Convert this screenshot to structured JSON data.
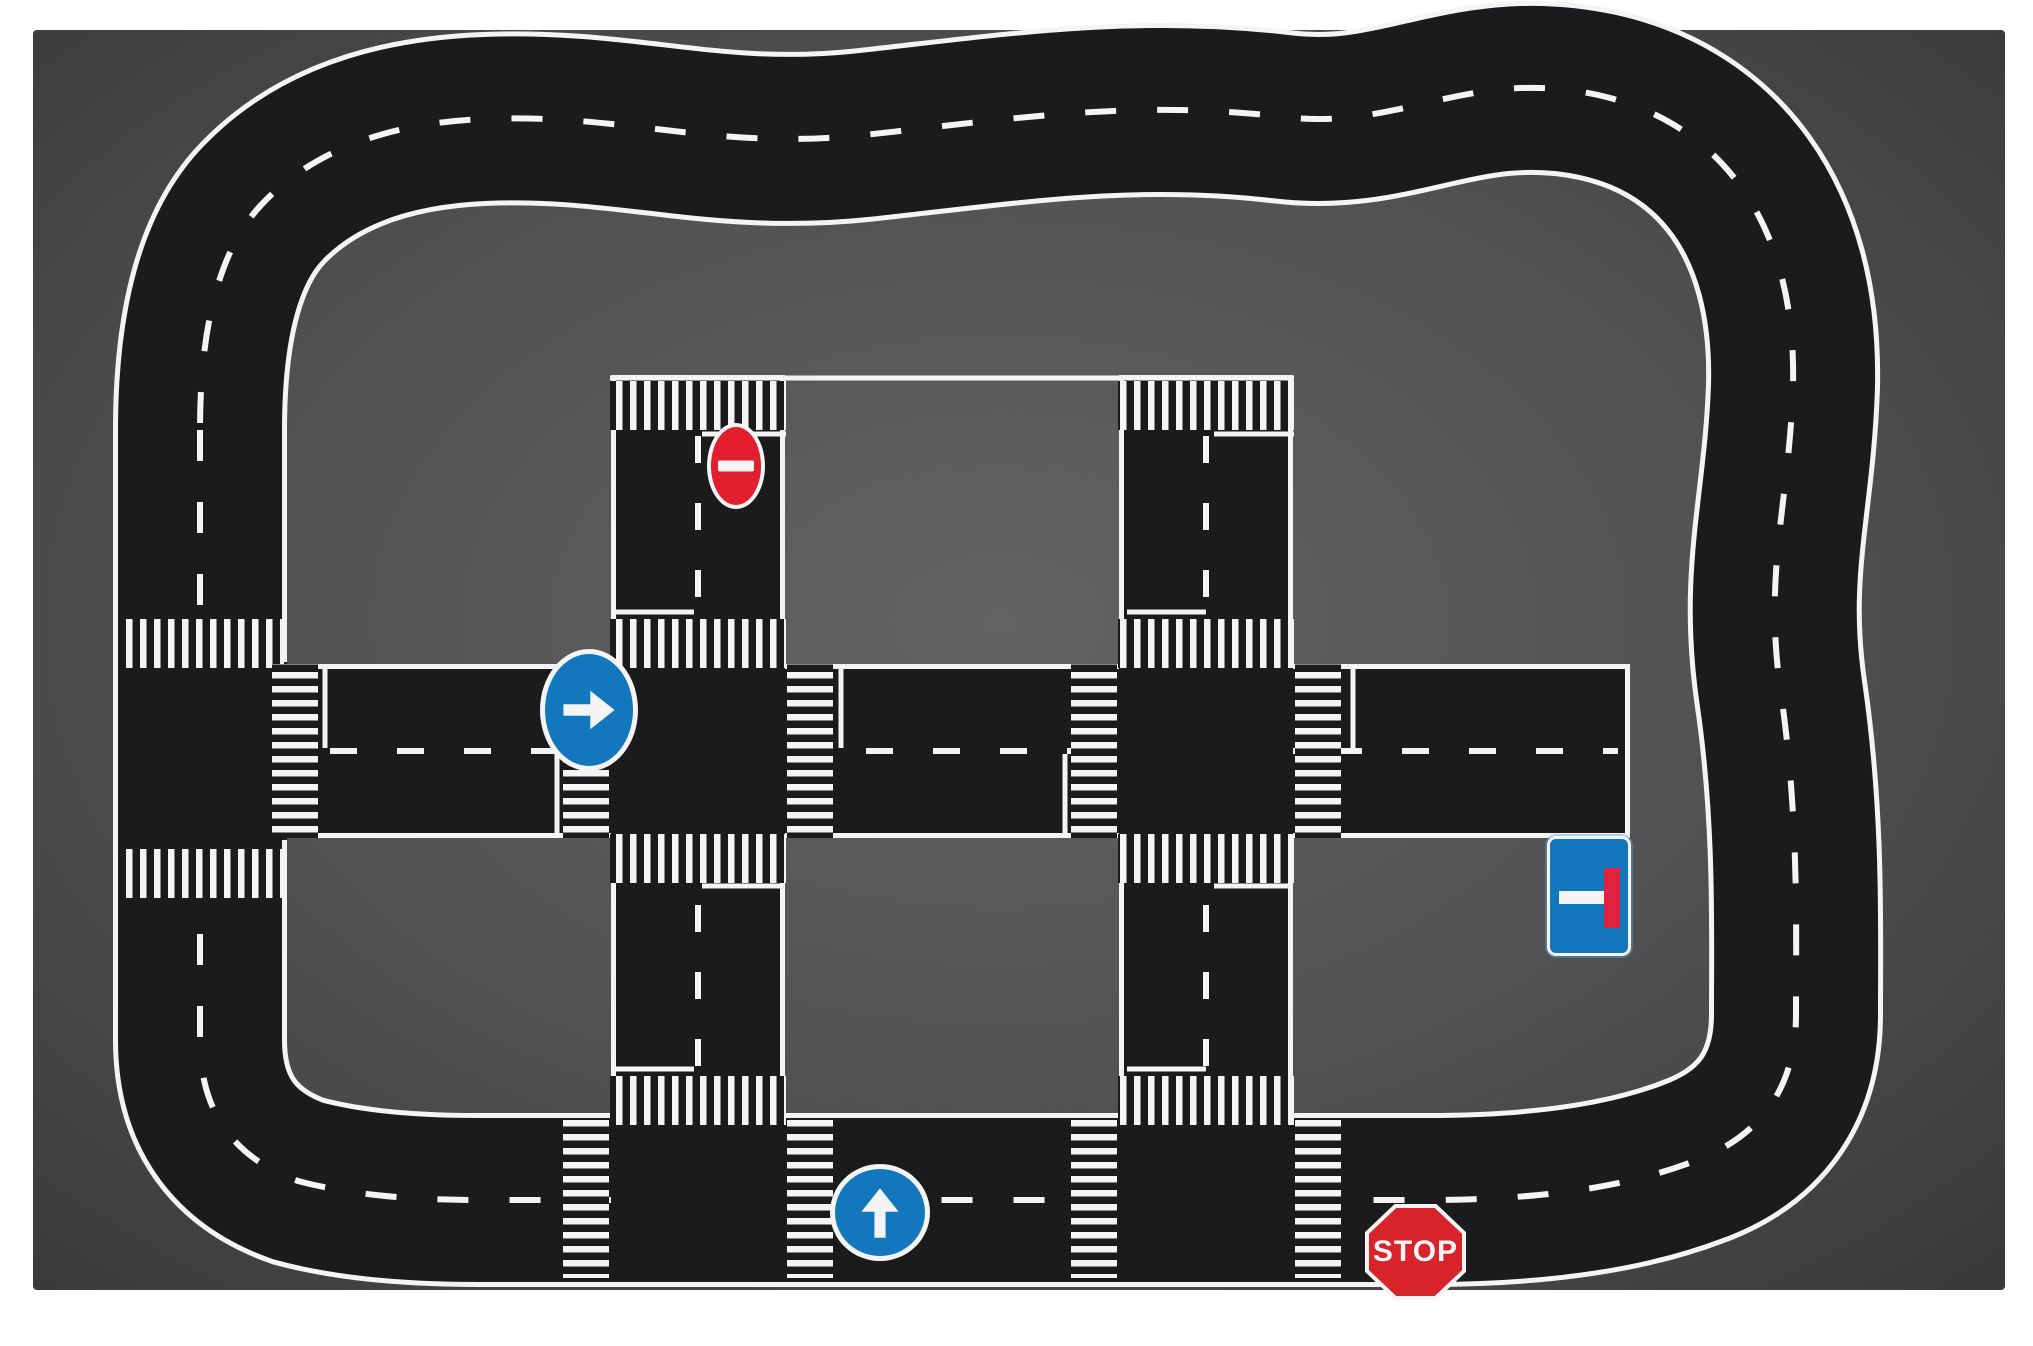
{
  "colors": {
    "page": "#ffffff",
    "road": "#1b1b1d",
    "marking": "#f4f4f4",
    "mat_gradient": [
      [
        "0%",
        "#636365"
      ],
      [
        "55%",
        "#515153"
      ],
      [
        "100%",
        "#3a3a3c"
      ]
    ],
    "sign_blue": "#1277bd",
    "noentry_red": "#e11f2e",
    "stop_red": "#d8232a",
    "deadend_red": "#e02340"
  },
  "signs": {
    "no_entry": {
      "icon": "no-entry-icon",
      "meaning": "no entry",
      "shape": "ellipse",
      "fill": "#e11f2e"
    },
    "turn_right": {
      "icon": "arrow-right-icon",
      "meaning": "mandatory turn right",
      "shape": "circle",
      "fill": "#1277bd"
    },
    "dead_end": {
      "icon": "dead-end-icon",
      "meaning": "dead end / no through road",
      "shape": "rounded-square",
      "fill": "#1277bd"
    },
    "ahead_only": {
      "icon": "arrow-up-icon",
      "meaning": "proceed straight ahead",
      "shape": "circle",
      "fill": "#1277bd"
    },
    "stop": {
      "icon": "stop-octagon-icon",
      "meaning": "stop",
      "label": "STOP",
      "shape": "octagon",
      "fill": "#d8232a"
    }
  },
  "playmat": {
    "canvas": {
      "width": 2033,
      "height": 1346
    },
    "mat": {
      "x": 33,
      "y": 30,
      "w": 1972,
      "h": 1260
    },
    "ring_road_path": "M 200 430 L 200 1040 Q 200 1146 298 1181 Q 368 1200 478 1200 L 1428 1200 Q 1592 1200 1692 1162 Q 1797 1124 1796 1012 C 1796 928 1799 818 1781 694 C 1763 572 1789 506 1793 386 C 1797 218 1716 121 1598 95 C 1468 67 1401 131 1284 117 C 1134 99 1011 119 864 135 C 714 151 626 113 484 119 Q 338 125 263 203 Q 200 268 200 430 Z",
    "layers": [
      {
        "kind": "rect",
        "x": 33,
        "y": 30,
        "w": 1972,
        "h": 1260,
        "rx": 4,
        "fill": "url(#matGrad)"
      },
      {
        "kind": "ringpath",
        "stroke": "marking",
        "w": 174
      },
      {
        "kind": "ringpath",
        "stroke": "road",
        "w": 164
      },
      {
        "kind": "ringpath",
        "stroke": "marking",
        "w": 6,
        "dash": "31 41"
      },
      {
        "kind": "path",
        "d": "M 196 751 L 1630 751",
        "stroke": "marking",
        "w": 174
      },
      {
        "kind": "path",
        "d": "M 196 751 L 1625 751",
        "stroke": "road",
        "w": 164
      },
      {
        "kind": "path",
        "d": "M 196 751 L 1618 751",
        "stroke": "marking",
        "w": 6,
        "dash": "27 40"
      },
      {
        "kind": "path",
        "d": "M 698 375 L 698 1200",
        "stroke": "marking",
        "w": 174
      },
      {
        "kind": "path",
        "d": "M 698 380 L 698 1200",
        "stroke": "road",
        "w": 164
      },
      {
        "kind": "path",
        "d": "M 698 436 L 698 1140",
        "stroke": "marking",
        "w": 6,
        "dash": "27 40"
      },
      {
        "kind": "path",
        "d": "M 1206 375 L 1206 1200",
        "stroke": "marking",
        "w": 174
      },
      {
        "kind": "path",
        "d": "M 1206 380 L 1206 1200",
        "stroke": "road",
        "w": 164
      },
      {
        "kind": "path",
        "d": "M 1206 436 L 1206 1140",
        "stroke": "marking",
        "w": 6,
        "dash": "27 40"
      },
      {
        "kind": "rect",
        "x": 126,
        "y": 662,
        "w": 161,
        "h": 178,
        "fill": "road"
      },
      {
        "kind": "rect",
        "x": 611,
        "y": 662,
        "w": 174,
        "h": 178,
        "fill": "road"
      },
      {
        "kind": "rect",
        "x": 1119,
        "y": 662,
        "w": 174,
        "h": 178,
        "fill": "road"
      },
      {
        "kind": "rect",
        "x": 611,
        "y": 1113,
        "w": 174,
        "h": 166,
        "fill": "road"
      },
      {
        "kind": "rect",
        "x": 1119,
        "y": 1113,
        "w": 174,
        "h": 166,
        "fill": "road"
      },
      {
        "kind": "line",
        "x1": 615,
        "y1": 612,
        "x2": 694,
        "y2": 612
      },
      {
        "kind": "line",
        "x1": 1127,
        "y1": 612,
        "x2": 1206,
        "y2": 612
      },
      {
        "kind": "line",
        "x1": 702,
        "y1": 886,
        "x2": 781,
        "y2": 886
      },
      {
        "kind": "line",
        "x1": 1214,
        "y1": 886,
        "x2": 1293,
        "y2": 886
      },
      {
        "kind": "line",
        "x1": 615,
        "y1": 1069,
        "x2": 694,
        "y2": 1069
      },
      {
        "kind": "line",
        "x1": 1127,
        "y1": 1069,
        "x2": 1206,
        "y2": 1069
      },
      {
        "kind": "line",
        "x1": 325,
        "y1": 669,
        "x2": 325,
        "y2": 748
      },
      {
        "kind": "line",
        "x1": 841,
        "y1": 669,
        "x2": 841,
        "y2": 748
      },
      {
        "kind": "line",
        "x1": 1353,
        "y1": 669,
        "x2": 1353,
        "y2": 748
      },
      {
        "kind": "line",
        "x1": 557,
        "y1": 754,
        "x2": 557,
        "y2": 833
      },
      {
        "kind": "line",
        "x1": 1065,
        "y1": 754,
        "x2": 1065,
        "y2": 833
      },
      {
        "kind": "line",
        "x1": 702,
        "y1": 434,
        "x2": 786,
        "y2": 434
      },
      {
        "kind": "line",
        "x1": 1214,
        "y1": 434,
        "x2": 1294,
        "y2": 434
      },
      {
        "kind": "rect",
        "x": 610,
        "y": 381,
        "w": 176,
        "h": 49,
        "fill": "url(#patV)"
      },
      {
        "kind": "rect",
        "x": 610,
        "y": 619,
        "w": 176,
        "h": 49,
        "fill": "url(#patV)"
      },
      {
        "kind": "rect",
        "x": 610,
        "y": 834,
        "w": 176,
        "h": 49,
        "fill": "url(#patV)"
      },
      {
        "kind": "rect",
        "x": 610,
        "y": 1076,
        "w": 176,
        "h": 49,
        "fill": "url(#patV)"
      },
      {
        "kind": "rect",
        "x": 1118,
        "y": 381,
        "w": 176,
        "h": 49,
        "fill": "url(#patV)"
      },
      {
        "kind": "rect",
        "x": 1118,
        "y": 619,
        "w": 176,
        "h": 49,
        "fill": "url(#patV)"
      },
      {
        "kind": "rect",
        "x": 1118,
        "y": 834,
        "w": 176,
        "h": 49,
        "fill": "url(#patV)"
      },
      {
        "kind": "rect",
        "x": 1118,
        "y": 1076,
        "w": 176,
        "h": 49,
        "fill": "url(#patV)"
      },
      {
        "kind": "rect",
        "x": 121,
        "y": 619,
        "w": 163,
        "h": 49,
        "fill": "url(#patV)"
      },
      {
        "kind": "rect",
        "x": 121,
        "y": 849,
        "w": 163,
        "h": 49,
        "fill": "url(#patV)"
      },
      {
        "kind": "rect",
        "x": 272,
        "y": 664,
        "w": 46,
        "h": 174,
        "fill": "url(#patH)"
      },
      {
        "kind": "rect",
        "x": 563,
        "y": 664,
        "w": 46,
        "h": 174,
        "fill": "url(#patH)"
      },
      {
        "kind": "rect",
        "x": 787,
        "y": 664,
        "w": 46,
        "h": 174,
        "fill": "url(#patH)"
      },
      {
        "kind": "rect",
        "x": 1071,
        "y": 664,
        "w": 46,
        "h": 174,
        "fill": "url(#patH)"
      },
      {
        "kind": "rect",
        "x": 1295,
        "y": 664,
        "w": 46,
        "h": 174,
        "fill": "url(#patH)"
      },
      {
        "kind": "rect",
        "x": 563,
        "y": 1118,
        "w": 46,
        "h": 160,
        "fill": "url(#patH)"
      },
      {
        "kind": "rect",
        "x": 787,
        "y": 1118,
        "w": 46,
        "h": 160,
        "fill": "url(#patH)"
      },
      {
        "kind": "rect",
        "x": 1071,
        "y": 1118,
        "w": 46,
        "h": 160,
        "fill": "url(#patH)"
      },
      {
        "kind": "rect",
        "x": 1295,
        "y": 1118,
        "w": 46,
        "h": 160,
        "fill": "url(#patH)"
      },
      {
        "kind": "line",
        "x1": 610,
        "y1": 378,
        "x2": 1294,
        "y2": 378
      }
    ]
  }
}
